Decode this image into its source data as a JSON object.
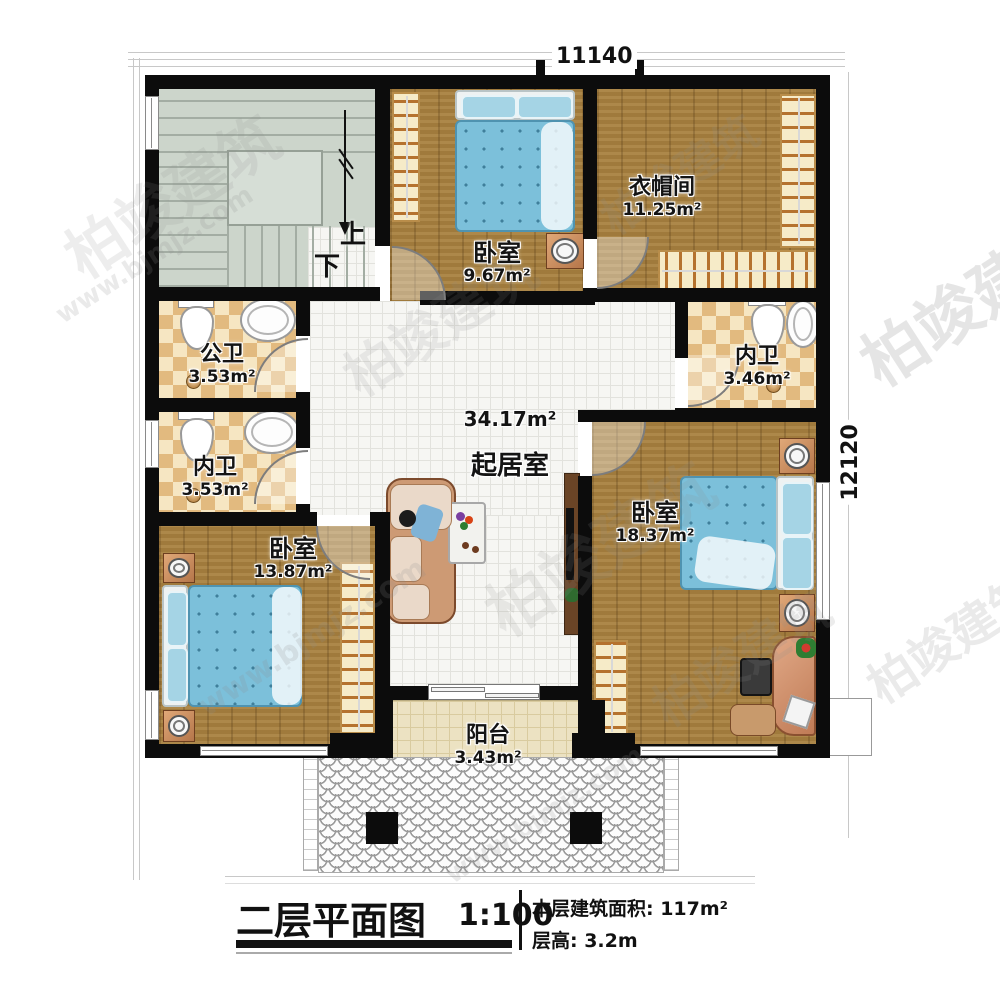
{
  "watermark": {
    "brand": "柏竣建筑",
    "site": "www.bjmjz.com"
  },
  "dimensions": {
    "top_width": "11140",
    "right_height": "12120"
  },
  "stairs": {
    "up": "上",
    "down": "下"
  },
  "rooms": [
    {
      "name": "卧室",
      "area": "9.67m²"
    },
    {
      "name": "衣帽间",
      "area": "11.25m²"
    },
    {
      "name": "公卫",
      "area": "3.53m²"
    },
    {
      "name": "内卫",
      "area": "3.53m²"
    },
    {
      "name": "内卫",
      "area": "3.46m²"
    },
    {
      "name": "起居室",
      "area": "34.17m²"
    },
    {
      "name": "卧室",
      "area": "13.87m²"
    },
    {
      "name": "卧室",
      "area": "18.37m²"
    },
    {
      "name": "阳台",
      "area": "3.43m²"
    }
  ],
  "title_block": {
    "title": "二层平面图",
    "scale": "1:100",
    "floor_area": "本层建筑面积: 117m²",
    "floor_height": "层高: 3.2m"
  },
  "colors": {
    "wall": "#0c0c0c",
    "wood_floor": "#a8813f",
    "tile_floor": "#f6f6f3",
    "checker_dark": "#e2ba7f",
    "checker_light": "#f6e6c2",
    "stair_floor": "#ccd5cb",
    "balcony_floor": "#ece2c2",
    "bed_blue": "#7cc0da",
    "copper_accent": "#c98a5c"
  }
}
